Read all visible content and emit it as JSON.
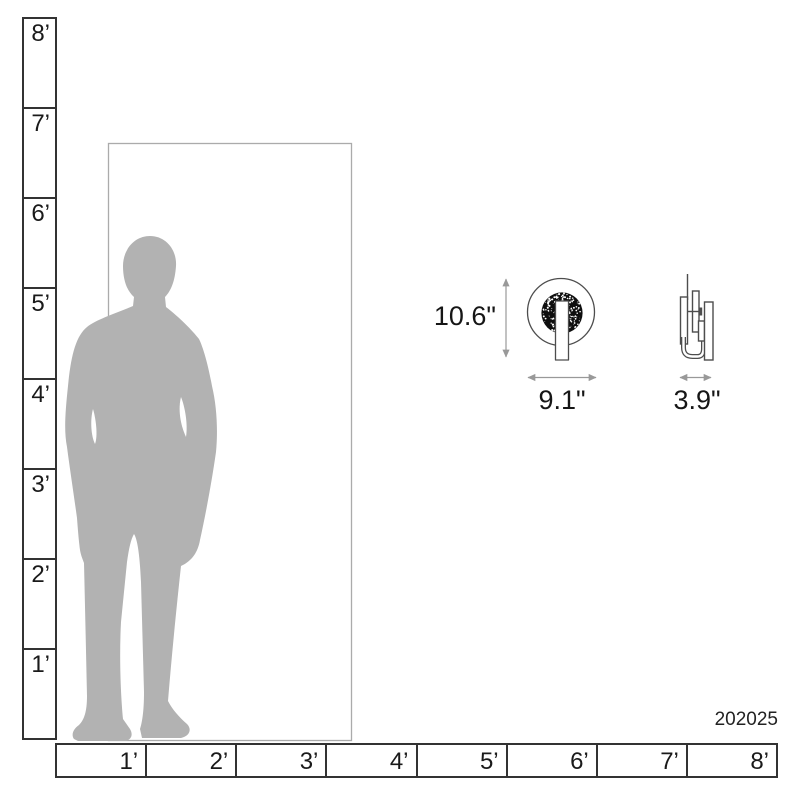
{
  "diagram": {
    "product_code": "202025",
    "dimensions": {
      "height": "10.6\"",
      "width": "9.1\"",
      "depth": "3.9\""
    }
  },
  "vertical_ruler": {
    "labels": [
      "8’",
      "7’",
      "6’",
      "5’",
      "4’",
      "3’",
      "2’",
      "1’"
    ]
  },
  "horizontal_ruler": {
    "labels": [
      "1’",
      "2’",
      "3’",
      "4’",
      "5’",
      "6’",
      "7’",
      "8’"
    ]
  },
  "colors": {
    "silhouette": "#b2b2b2",
    "ruler_line": "#333333",
    "door_line": "#ababab",
    "product_line": "#4d4d4d",
    "arrow": "#999999",
    "speckle_disc": "#0e0e0e",
    "text": "#1a1a1a"
  }
}
